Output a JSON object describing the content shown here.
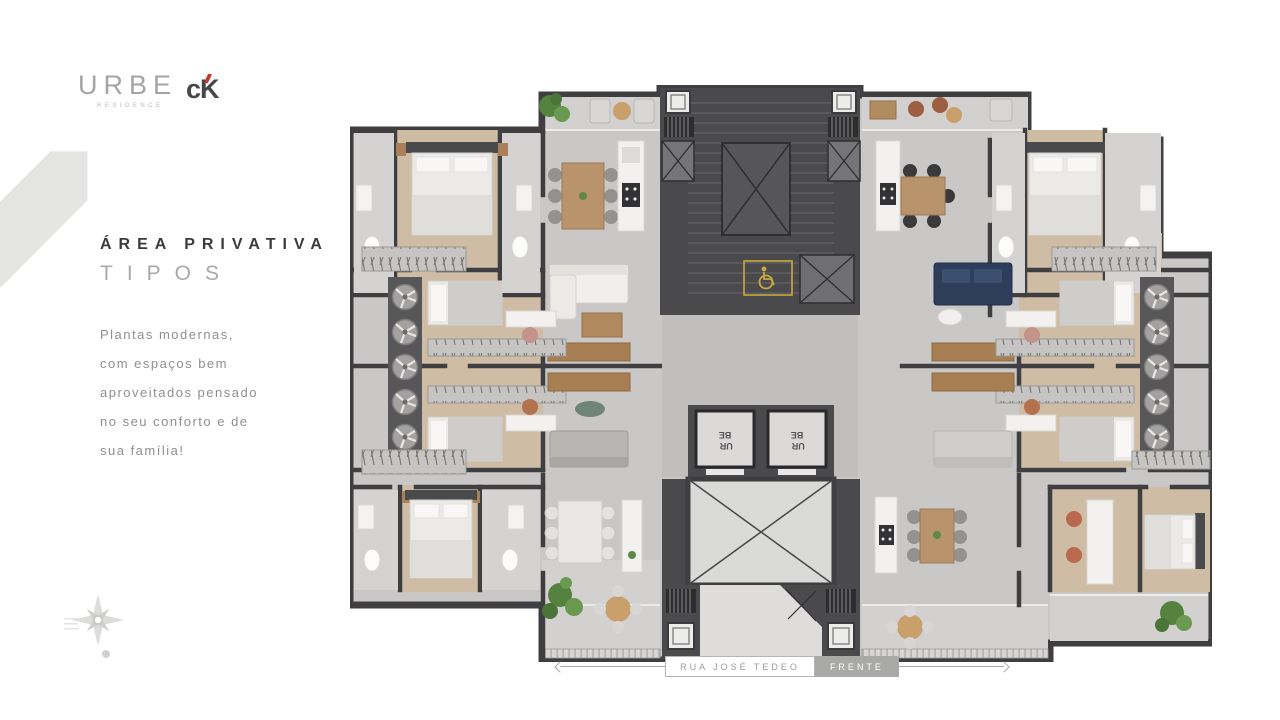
{
  "brand": {
    "primary_logo": "URBE",
    "primary_logo_sub": "RESIDENCE",
    "secondary_logo": "cK"
  },
  "panel": {
    "title": "ÁREA PRIVATIVA",
    "subtitle": "TIPOS",
    "body": "Plantas modernas,\ncom espaços bem\naproveitados pensado\nno seu conforto e de\nsua família!"
  },
  "floorplan": {
    "elevator_line1": "UR",
    "elevator_line2": "BE",
    "icons": {
      "accessibility": "wheelchair-icon",
      "compass": "compass-rose-icon",
      "condenser": "fan-icon"
    }
  },
  "footer": {
    "street": "RUA JOSÉ TEDEO",
    "front": "FRENTE"
  },
  "colors": {
    "wall": "#3f3f42",
    "core": "#4a4a4d",
    "floor": "#c9c8c6",
    "terrace_floor": "#d2d1cf",
    "wood_floor": "#cfbca4",
    "wood_furniture": "#b9936c",
    "accent_yellow": "#c9a940",
    "navy_sofa": "#2e3d59",
    "plant_green": "#5d8a46",
    "brand_red": "#c0392b",
    "logo_gray": "#a4a4a8",
    "title_dark": "#3b3b3b",
    "text_gray": "#8f8f8f"
  }
}
